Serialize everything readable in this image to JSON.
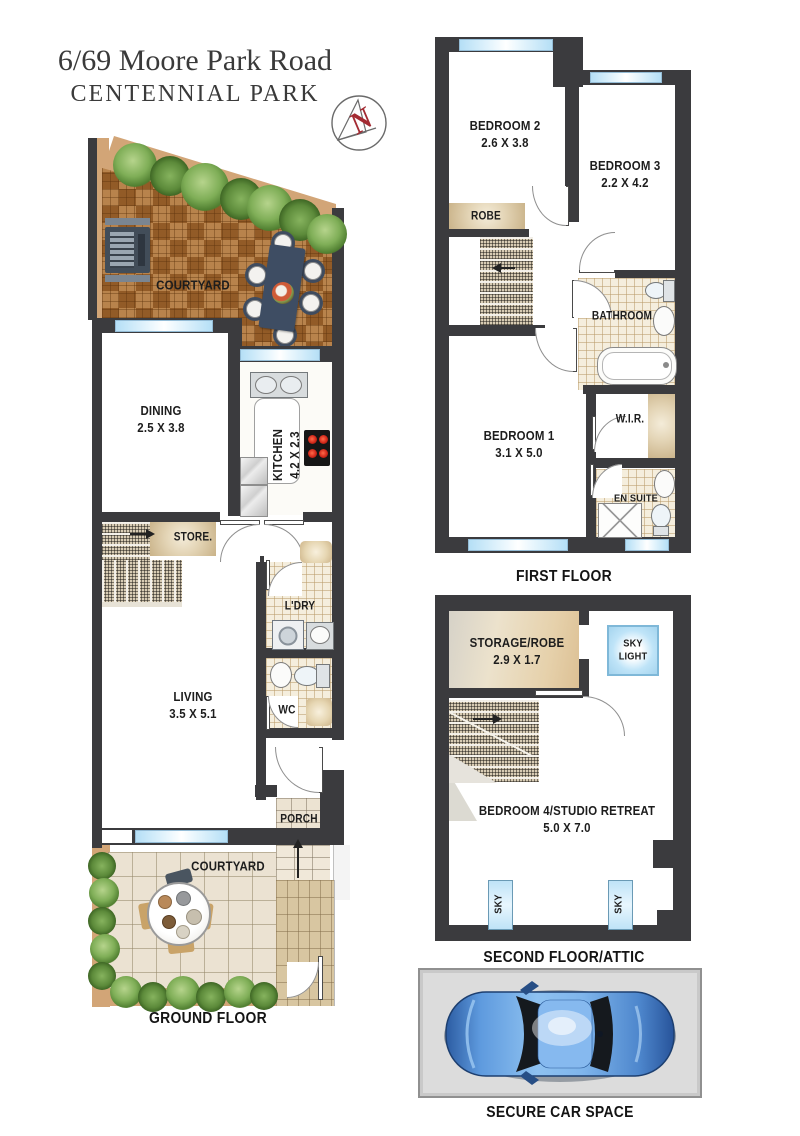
{
  "title": {
    "line1": "6/69 Moore Park Road",
    "line2": "CENTENNIAL PARK"
  },
  "compass": {
    "label": "N"
  },
  "palette": {
    "wall": "#3b3b3e",
    "window_blue": "#bfe3f7",
    "deck_brown": "#a4692f",
    "tan": "#d2a577",
    "plant_green": "#6f9c4a",
    "tile_beige": "#f5eedd",
    "skylight_blue": "#bfe4f8",
    "compass_red": "#a32a32",
    "car_blue": "#4a86d8",
    "car_space_bg": "#dcdcdc"
  },
  "floors": {
    "ground": {
      "caption": "GROUND FLOOR",
      "rooms": {
        "courtyard_top": {
          "name": "COURTYARD"
        },
        "dining": {
          "name": "DINING",
          "dims": "2.5 X 3.8"
        },
        "kitchen": {
          "name": "KITCHEN",
          "dims": "4.2 X 2.3"
        },
        "store": {
          "name": "STORE."
        },
        "laundry": {
          "name": "L'DRY"
        },
        "wc": {
          "name": "WC"
        },
        "living": {
          "name": "LIVING",
          "dims": "3.5 X 5.1"
        },
        "porch": {
          "name": "PORCH"
        },
        "courtyard_bottom": {
          "name": "COURTYARD"
        }
      }
    },
    "first": {
      "caption": "FIRST FLOOR",
      "rooms": {
        "bedroom2": {
          "name": "BEDROOM 2",
          "dims": "2.6 X 3.8"
        },
        "bedroom3": {
          "name": "BEDROOM 3",
          "dims": "2.2 X 4.2"
        },
        "robe": {
          "name": "ROBE"
        },
        "bathroom": {
          "name": "BATHROOM"
        },
        "bedroom1": {
          "name": "BEDROOM 1",
          "dims": "3.1 X 5.0"
        },
        "wir": {
          "name": "W.I.R."
        },
        "ensuite": {
          "name": "EN SUITE"
        }
      }
    },
    "second": {
      "caption": "SECOND FLOOR/ATTIC",
      "rooms": {
        "storage": {
          "name": "STORAGE/ROBE",
          "dims": "2.9 X 1.7"
        },
        "skylight": {
          "line1": "SKY",
          "line2": "LIGHT"
        },
        "bedroom4": {
          "name": "BEDROOM 4/STUDIO RETREAT",
          "dims": "5.0 X 7.0"
        },
        "sky_left": {
          "name": "SKY"
        },
        "sky_right": {
          "name": "SKY"
        }
      }
    }
  },
  "car_space": {
    "caption": "SECURE CAR SPACE"
  }
}
